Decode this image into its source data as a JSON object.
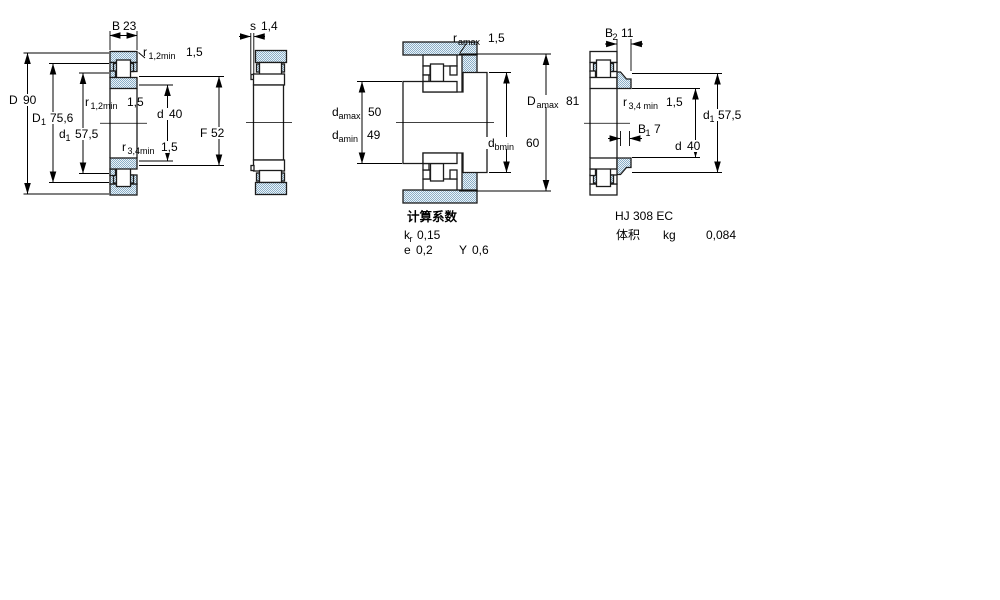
{
  "front": {
    "B": {
      "sym": "B",
      "val": "23"
    },
    "r12_top": {
      "sym": "r",
      "sub": "1,2min",
      "val": "1,5"
    },
    "D": {
      "sym": "D",
      "val": "90"
    },
    "D1": {
      "sym": "D",
      "sub": "1",
      "val": "75,6"
    },
    "d1": {
      "sym": "d",
      "sub": "1",
      "val": "57,5"
    },
    "r12_mid": {
      "sym": "r",
      "sub": "1,2min",
      "val": "1,5"
    },
    "d": {
      "sym": "d",
      "val": "40"
    },
    "r34": {
      "sym": "r",
      "sub": "3,4min",
      "val": "1,5"
    },
    "F": {
      "sym": "F",
      "val": "52"
    }
  },
  "side": {
    "s": {
      "sym": "s",
      "val": "1,4"
    }
  },
  "mounting": {
    "ra": {
      "sym": "r",
      "sub": "amax",
      "val": "1,5"
    },
    "damax": {
      "sym": "d",
      "sub": "amax",
      "val": "50"
    },
    "damin": {
      "sym": "d",
      "sub": "amin",
      "val": "49"
    },
    "Da": {
      "sym": "D",
      "sub": "amax",
      "val": "81"
    },
    "db": {
      "sym": "d",
      "sub": "bmin",
      "val": "60"
    }
  },
  "ring": {
    "B2": {
      "sym": "B",
      "sub": "2",
      "val": "11"
    },
    "r34": {
      "sym": "r",
      "sub": "3,4 min",
      "val": "1,5"
    },
    "d1": {
      "sym": "d",
      "sub": "1",
      "val": "57,5"
    },
    "B1": {
      "sym": "B",
      "sub": "1",
      "val": "7"
    },
    "d": {
      "sym": "d",
      "val": "40"
    }
  },
  "calc": {
    "title": "计算系数",
    "kr": {
      "sym": "k",
      "sub": "r",
      "val": "0,15"
    },
    "e": {
      "sym": "e",
      "val": "0,2"
    },
    "Y": {
      "sym": "Y",
      "val": "0,6"
    }
  },
  "hj": {
    "designation": "HJ 308 EC",
    "mass_label": "体积",
    "mass_unit": "kg",
    "mass_value": "0,084"
  },
  "colors": {
    "steel_fill": "#89afc9",
    "outline": "#1b1b1b"
  }
}
